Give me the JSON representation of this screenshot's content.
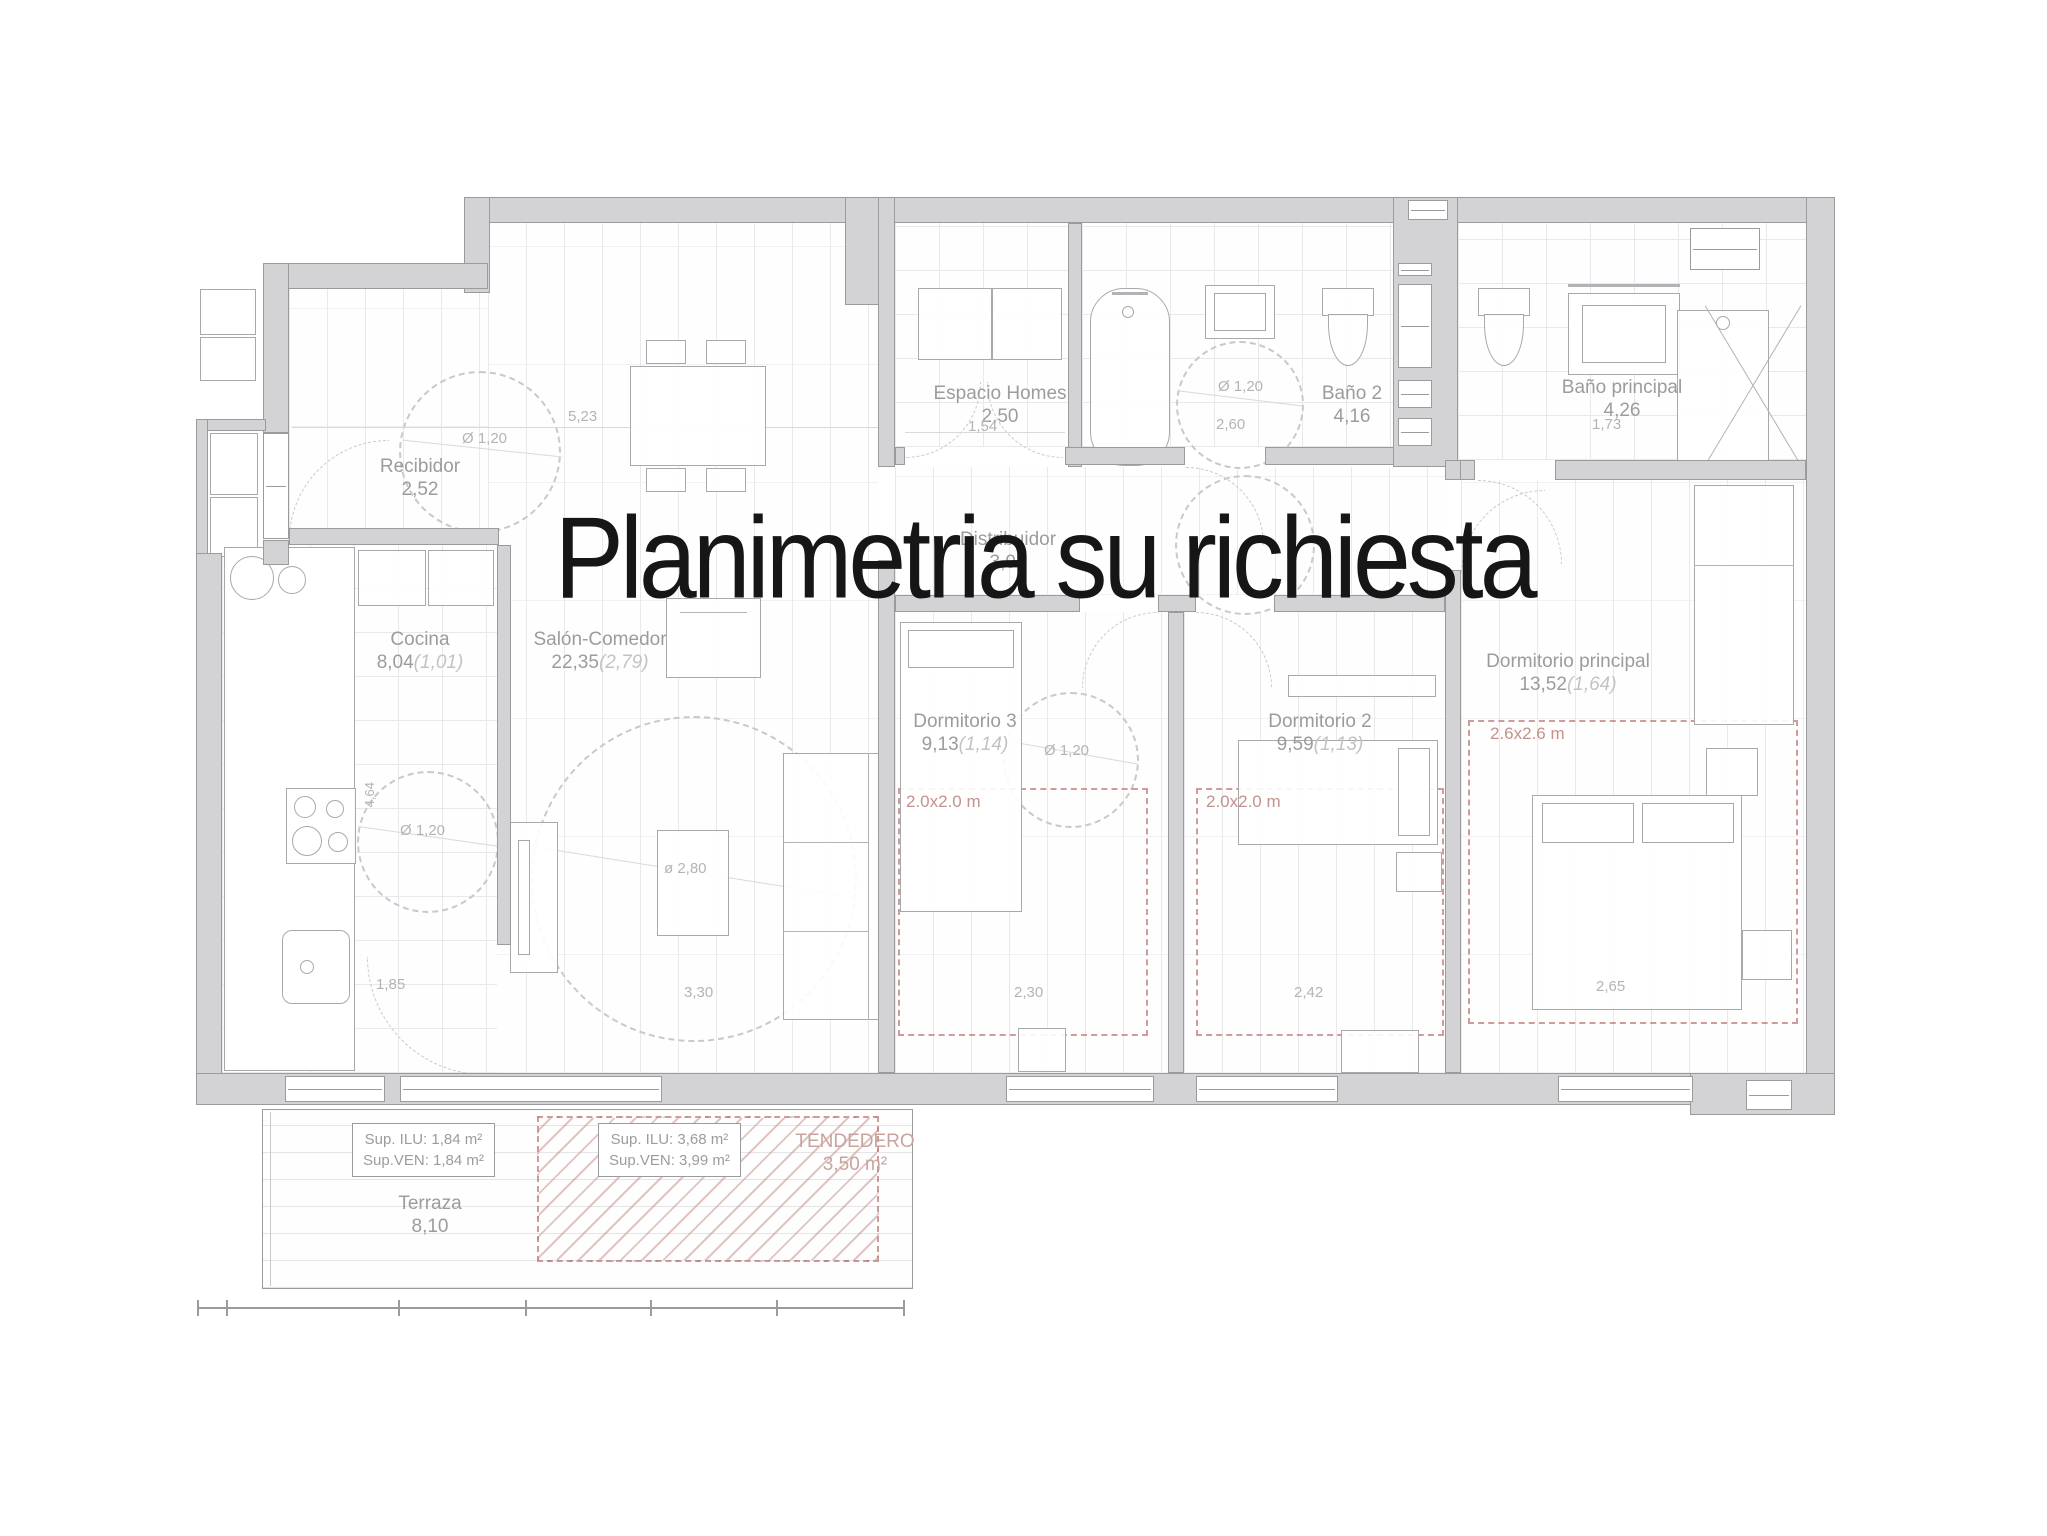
{
  "title": "Planimetria su richiesta",
  "rooms": {
    "recibidor": {
      "name": "Recibidor",
      "area": "2,52"
    },
    "cocina": {
      "name": "Cocina",
      "area": "8,04",
      "extra": "(1,01)"
    },
    "salon": {
      "name": "Salón-Comedor",
      "area": "22,35",
      "extra": "(2,79)"
    },
    "espacio_homes": {
      "name": "Espacio Homes",
      "area": "2,50"
    },
    "bano2": {
      "name": "Baño 2",
      "area": "4,16"
    },
    "bano_principal": {
      "name": "Baño principal",
      "area": "4,26"
    },
    "distribuidor": {
      "name": "Distribuidor",
      "area": "3,98"
    },
    "dormitorio3": {
      "name": "Dormitorio 3",
      "area": "9,13",
      "extra": "(1,14)"
    },
    "dormitorio2": {
      "name": "Dormitorio 2",
      "area": "9,59",
      "extra": "(1,13)"
    },
    "dormitorio_principal": {
      "name": "Dormitorio principal",
      "area": "13,52",
      "extra": "(1,64)"
    },
    "terraza": {
      "name": "Terraza",
      "area": "8,10"
    },
    "tendedero": {
      "name": "TENDEDERO",
      "area": "3,50 m²"
    }
  },
  "surface_boxes": {
    "terraza_window": {
      "ilu": "Sup. ILU:  1,84 m²",
      "ven": "Sup.VEN:  1,84 m²"
    },
    "salon_window": {
      "ilu": "Sup. ILU:  3,68 m²",
      "ven": "Sup.VEN:  3,99 m²"
    }
  },
  "dimensions": {
    "salon_width": "5,23",
    "recibidor_circle": "Ø 1,20",
    "espacio_width": "1,54",
    "bano2_circle": "Ø 1,20",
    "bano2_width": "2,60",
    "banop_width": "1,73",
    "cocina_circle": "Ø 1,20",
    "cocina_height": "4,64",
    "cocina_width": "1,85",
    "salon_circle": "ø 2,80",
    "salon_window": "3,30",
    "dorm3_circle": "Ø 1,20",
    "dorm3_window": "2,30",
    "dorm2_window": "2,42",
    "dormp_window": "2,65"
  },
  "clearance_boxes": {
    "dorm3": "2.0x2.0 m",
    "dorm2": "2.0x2.0 m",
    "dormp": "2.6x2.6 m"
  },
  "colors": {
    "wall_fill": "#d3d3d5",
    "wall_line": "#9b9b9e",
    "floor_line": "#e9e9ed",
    "label_text": "#9c9c9f",
    "dim_text": "#b4b4b7",
    "red_dashed": "#b05c58",
    "hatch": "#ba807a",
    "title_text": "#161616"
  }
}
